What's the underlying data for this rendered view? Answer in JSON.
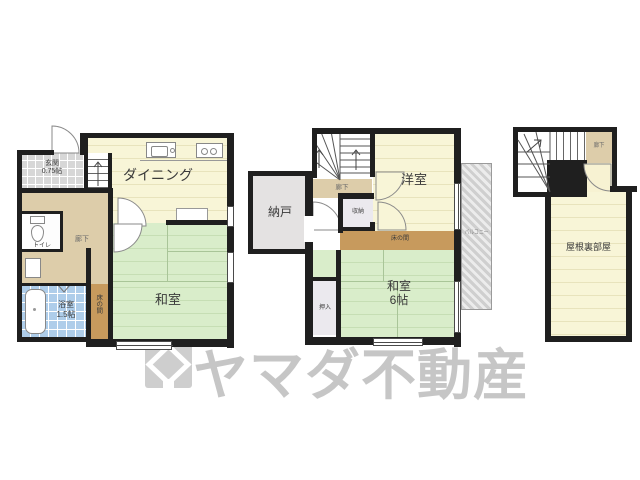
{
  "watermark": {
    "text": "ヤマダ不動産",
    "logo": "yamada-house-logo"
  },
  "floor1": {
    "genkan_l1": "玄関",
    "genkan_l2": "0.75帖",
    "dining": "ダイニング",
    "hall": "廊下",
    "toilet": "トイレ",
    "bath_l1": "浴室",
    "bath_l2": "1.5帖",
    "tokonoma": "床の間",
    "washitsu": "和室"
  },
  "floor2": {
    "nando": "納戸",
    "hall": "廊下",
    "closet": "収納",
    "yoshitsu": "洋室",
    "tokonoma": "床の間",
    "oshiire": "押入",
    "washitsu_l1": "和室",
    "washitsu_l2": "6帖",
    "balcony": "バルコニー"
  },
  "floor3": {
    "hall": "廊下",
    "attic": "屋根裏部屋"
  },
  "colors": {
    "wall": "#1f1f1f",
    "room_yellow": "#f8f5d7",
    "room_green": "#d9edca",
    "hall_tan": "#ddcdaa",
    "tokonoma_brown": "#c79a5d",
    "storage_gray": "#e4e2e2",
    "closet_gray": "#ebe9ee",
    "bath_blue": "#aecdea",
    "watermark_gray": "#8f8f8f"
  }
}
